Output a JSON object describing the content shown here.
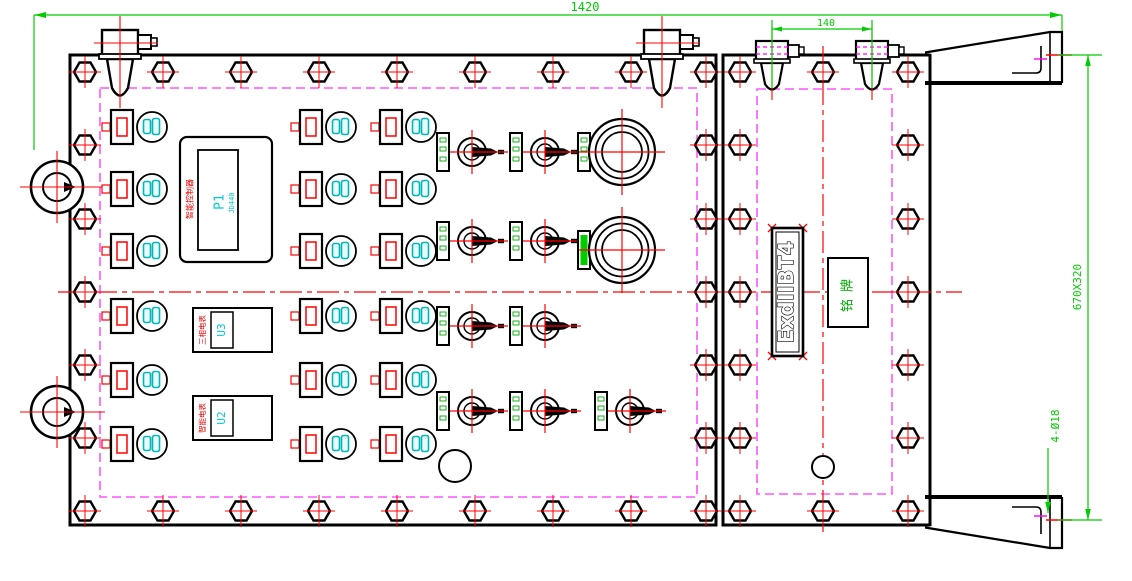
{
  "drawing": {
    "type": "engineering-cad",
    "view": "front-view-explosion-proof-control-box",
    "dimensions": {
      "total_width": "1420",
      "hinge_spacing": "140",
      "flange_size": "670X320",
      "mounting_holes": "4-Ø18"
    },
    "display": {
      "model": "P1",
      "sub_model": "JD440",
      "side_label": "智能控制器"
    },
    "meters": [
      {
        "model": "U3",
        "side_label": "三相电表"
      },
      {
        "model": "U2",
        "side_label": "智能电表"
      }
    ],
    "right_panel": {
      "ex_marking": "ExdIIBT4",
      "nameplate": "铭牌"
    },
    "colors": {
      "line": "#000000",
      "centerline": "#ff0000",
      "seal": "#ff55ff",
      "hatch": "#ff00ff",
      "dimension": "#00cc00",
      "indicator": "#00b8b8",
      "indicator_fill": "#eafafa",
      "accent_green": "#00aa00",
      "text_red": "#ee0000",
      "text_cyan": "#00c8d8"
    },
    "components": {
      "bolts": [
        [
          85,
          72
        ],
        [
          163,
          72
        ],
        [
          241,
          72
        ],
        [
          319,
          72
        ],
        [
          397,
          72
        ],
        [
          475,
          72
        ],
        [
          553,
          72
        ],
        [
          631,
          72
        ],
        [
          706,
          72
        ],
        [
          85,
          511
        ],
        [
          163,
          511
        ],
        [
          241,
          511
        ],
        [
          319,
          511
        ],
        [
          397,
          511
        ],
        [
          475,
          511
        ],
        [
          553,
          511
        ],
        [
          631,
          511
        ],
        [
          706,
          511
        ],
        [
          85,
          145
        ],
        [
          85,
          219
        ],
        [
          85,
          292
        ],
        [
          85,
          365
        ],
        [
          85,
          438
        ],
        [
          706,
          145
        ],
        [
          706,
          219
        ],
        [
          706,
          292
        ],
        [
          706,
          365
        ],
        [
          706,
          438
        ],
        [
          740,
          72
        ],
        [
          823,
          72
        ],
        [
          908,
          72
        ],
        [
          740,
          511
        ],
        [
          823,
          511
        ],
        [
          908,
          511
        ],
        [
          740,
          145
        ],
        [
          740,
          219
        ],
        [
          740,
          292
        ],
        [
          740,
          365
        ],
        [
          740,
          438
        ],
        [
          908,
          145
        ],
        [
          908,
          219
        ],
        [
          908,
          292
        ],
        [
          908,
          365
        ],
        [
          908,
          438
        ]
      ],
      "button_columns": [
        122,
        311,
        391
      ],
      "button_rows": [
        127,
        189,
        251,
        316,
        380,
        444
      ],
      "switch_columns": [
        {
          "plate_x": 437,
          "x": 472,
          "rows": [
            152,
            241,
            326,
            411
          ]
        },
        {
          "plate_x": 510,
          "x": 545,
          "rows": [
            152,
            241,
            326,
            411
          ]
        },
        {
          "plate_x": 595,
          "x": 630,
          "rows": [
            411
          ]
        }
      ],
      "sight_glasses": [
        {
          "x": 622,
          "y": 152,
          "plate_x": 578,
          "plate_solid": false
        },
        {
          "x": 622,
          "y": 250,
          "plate_x": 578,
          "plate_solid": true
        }
      ],
      "hinges_large_x": [
        120,
        662
      ],
      "hinges_small_x": [
        772,
        872
      ],
      "lifting_lugs": [
        [
          57,
          187
        ],
        [
          57,
          412
        ]
      ],
      "aux_holes": [
        [
          455,
          466,
          16
        ],
        [
          823,
          467,
          11
        ]
      ]
    }
  }
}
